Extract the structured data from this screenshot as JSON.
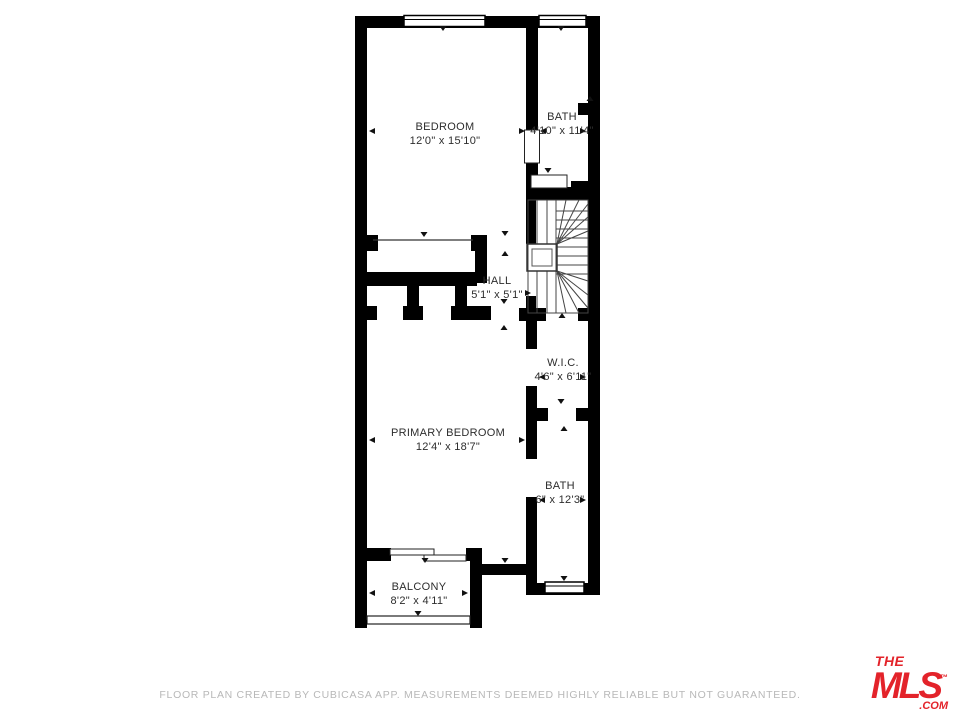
{
  "floor_plan": {
    "rooms": [
      {
        "name": "BEDROOM",
        "dimensions": "12'0\" x 15'10\""
      },
      {
        "name": "BATH",
        "dimensions": "4'10\" x 11'4\""
      },
      {
        "name": "HALL",
        "dimensions": "5'1\" x 5'1\""
      },
      {
        "name": "W.I.C.",
        "dimensions": "4'6\" x 6'11\""
      },
      {
        "name": "PRIMARY BEDROOM",
        "dimensions": "12'4\" x 18'7\""
      },
      {
        "name": "BATH",
        "dimensions": "6\" x 12'3\""
      },
      {
        "name": "BALCONY",
        "dimensions": "8'2\" x 4'11\""
      }
    ]
  },
  "footer": {
    "disclaimer": "FLOOR PLAN CREATED BY CUBICASA APP. MEASUREMENTS DEEMED HIGHLY RELIABLE BUT NOT GUARANTEED."
  },
  "logo": {
    "the": "THE",
    "mls": "MLS",
    "trademark": "™",
    "com": ".COM"
  },
  "colors": {
    "wall": "#000000",
    "label_text": "#2d2d2d",
    "footer_text": "#b8b8b8",
    "logo_red": "#E3232A"
  }
}
